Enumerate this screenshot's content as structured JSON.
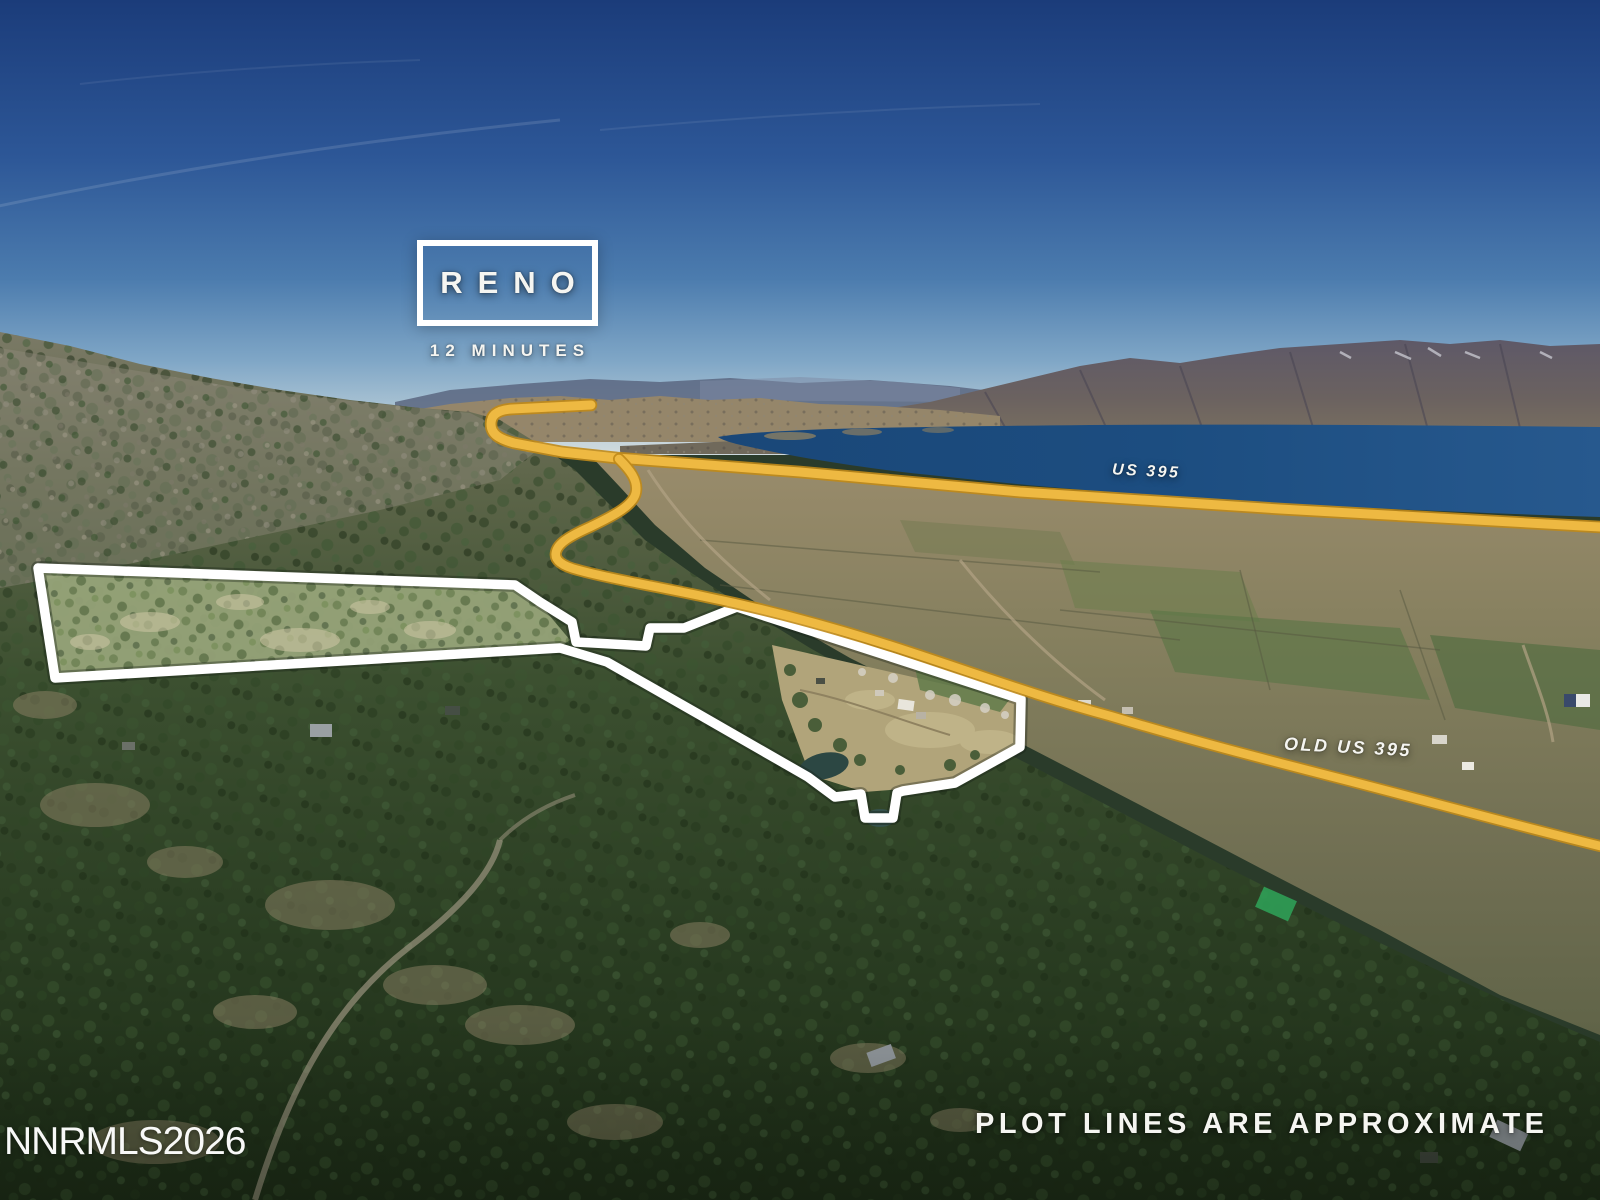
{
  "photo": {
    "kind": "aerial-property-listing-photo",
    "width_px": 1600,
    "height_px": 1200
  },
  "callout": {
    "title": "RENO",
    "subtitle": "12 MINUTES"
  },
  "road_labels": {
    "us395": "US 395",
    "old_us395": "OLD US 395"
  },
  "disclaimer": "PLOT LINES ARE APPROXIMATE",
  "watermark": "NNRMLS2026",
  "colors": {
    "route_gold": "#EEB942",
    "route_gold_edge": "#C08A18",
    "boundary_white": "#FFFFFF",
    "sky_top_blue": "#1B3C7A",
    "lake_blue": "#1C4D80",
    "forest_green": "#2F4527",
    "valley_tan": "#9A8C6C",
    "mountain_slate": "#5D5868"
  }
}
